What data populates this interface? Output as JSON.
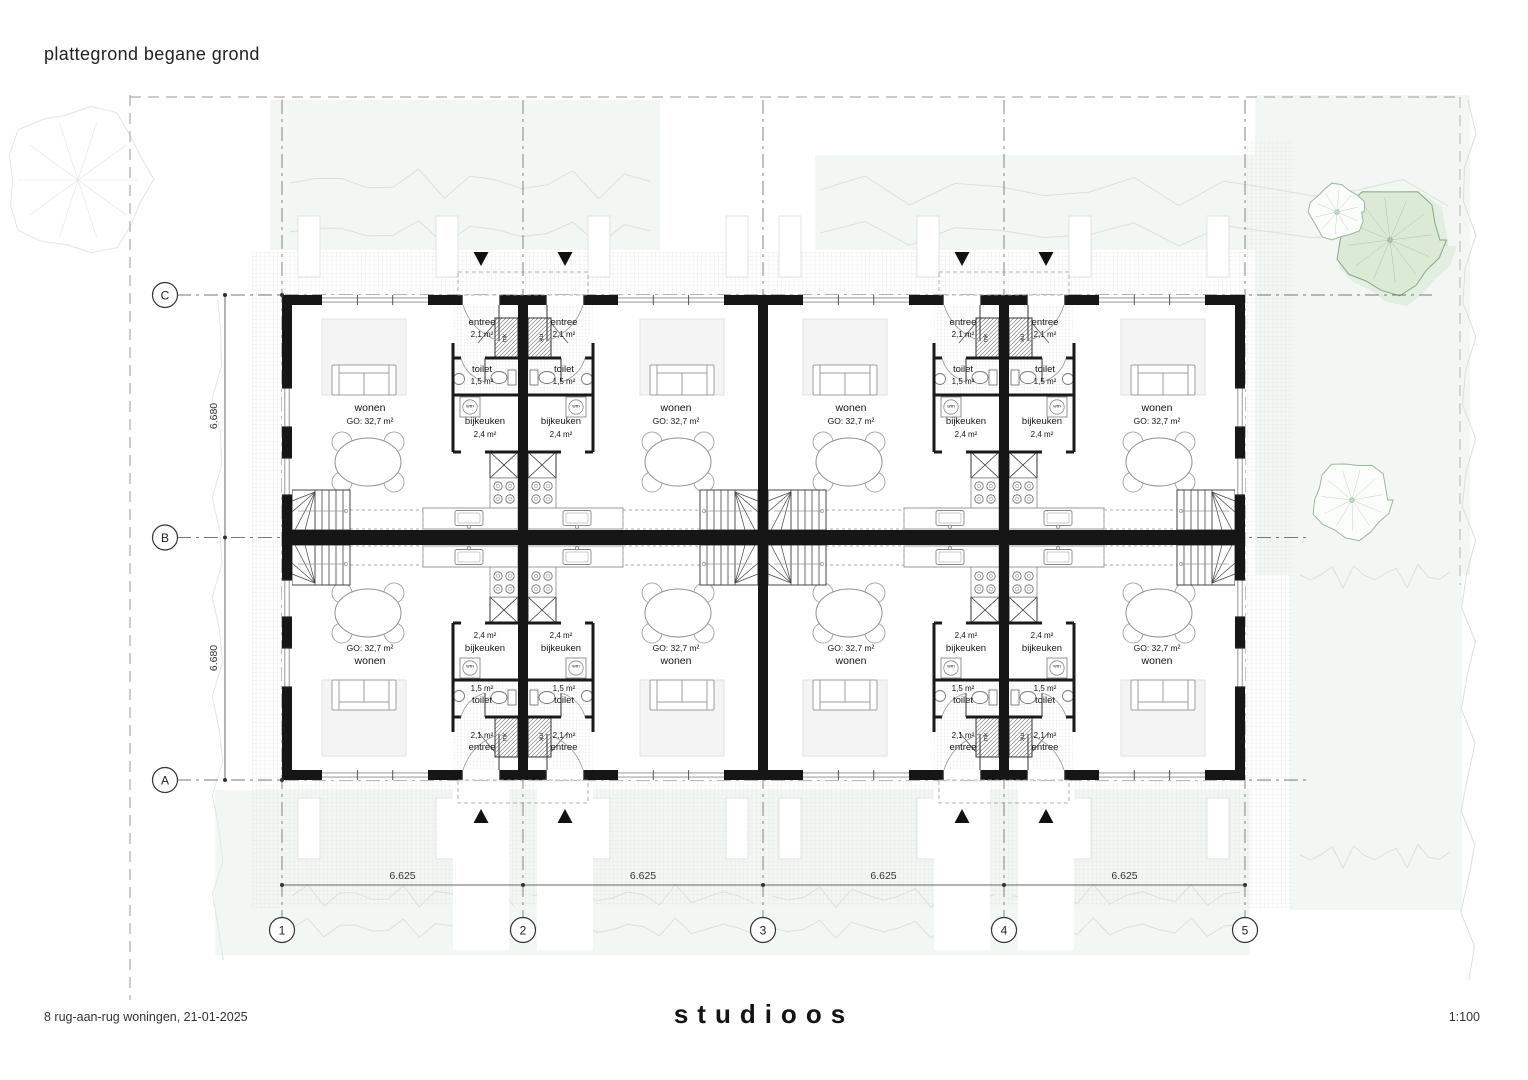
{
  "header": {
    "title": "plattegrond begane grond"
  },
  "footer": {
    "project": "8 rug-aan-rug woningen, 21-01-2025",
    "logo": "studioos",
    "scale": "1:100"
  },
  "grid": {
    "row_labels": [
      "C",
      "B",
      "A"
    ],
    "col_labels": [
      "1",
      "2",
      "3",
      "4",
      "5"
    ]
  },
  "dimensions": {
    "vertical": [
      "6.680",
      "6.680"
    ],
    "horizontal": [
      "6.625",
      "6.625",
      "6.625",
      "6.625"
    ]
  },
  "rooms": {
    "wonen": {
      "name": "wonen",
      "area": "GO: 32,7 m²"
    },
    "entree": {
      "name": "entree",
      "area": "2,1 m²"
    },
    "toilet": {
      "name": "toilet",
      "area": "1,5 m²"
    },
    "bijkeuken": {
      "name": "bijkeuken",
      "area": "2,4 m²"
    },
    "wm": "wm",
    "mk": "mk"
  }
}
